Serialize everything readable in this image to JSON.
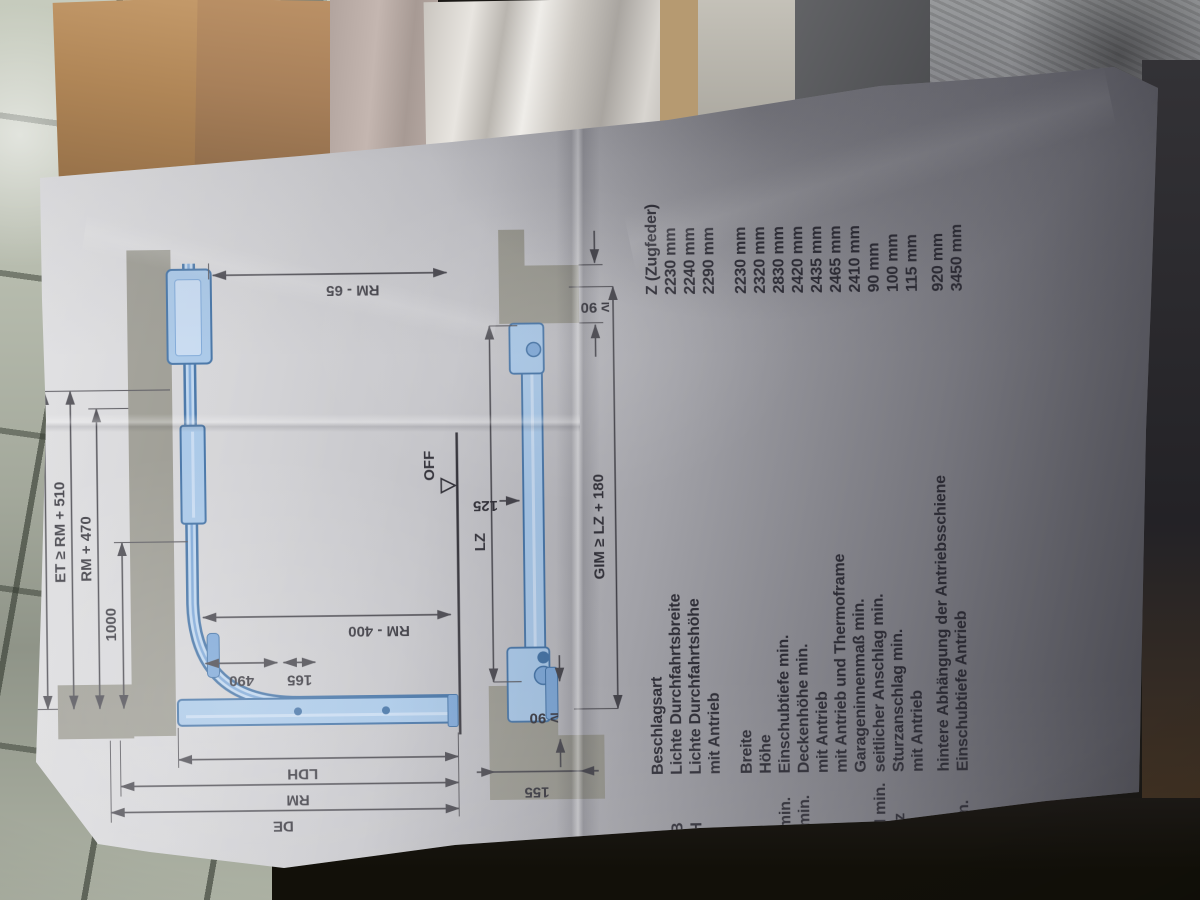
{
  "photo": {
    "description": "Crumpled garage-door fitting instruction sheet photographed on a tiled floor, rotated 90 degrees",
    "colors": {
      "diagram_blue_fill": "#a6c6e7",
      "diagram_blue_stroke": "#3f6fa3",
      "masonry_gray": "#99988f",
      "print_ink": "#32313a",
      "paper_light": "#e0e0e2",
      "paper_shadow": "#717078"
    },
    "table": {
      "rows": [
        {
          "abbr": "",
          "label": "Beschlagsart",
          "value": "Z (Zugfeder)"
        },
        {
          "abbr": "LDB",
          "label": "Lichte Durchfahrtsbreite",
          "value": "2230 mm"
        },
        {
          "abbr": "LDH",
          "label": "Lichte Durchfahrtshöhe",
          "value": "2240 mm"
        },
        {
          "abbr": "",
          "label": "mit Antrieb",
          "value": "2290 mm"
        },
        {
          "abbr": "LZ",
          "label": "Breite",
          "value": "2230 mm"
        },
        {
          "abbr": "RM",
          "label": "Höhe",
          "value": "2320 mm"
        },
        {
          "abbr": "ET min.",
          "label": "Einschubtiefe min.",
          "value": "2830 mm"
        },
        {
          "abbr": "DE min.",
          "label": "Deckenhöhe min.",
          "value": "2420 mm"
        },
        {
          "abbr": "",
          "label": "mit Antrieb",
          "value": "2435 mm"
        },
        {
          "abbr": "",
          "label": "mit Antrieb und Thermoframe",
          "value": "2465 mm"
        },
        {
          "abbr": "GIM",
          "label": "Garageninnenmaß min.",
          "value": "2410 mm"
        },
        {
          "abbr": "SAN min.",
          "label": "seitlicher Anschlag min.",
          "value": "90 mm"
        },
        {
          "abbr": "Sturz",
          "label": "Sturzanschlag min.",
          "value": "100 mm"
        },
        {
          "abbr": "",
          "label": "mit Antrieb",
          "value": "115 mm"
        },
        {
          "abbr": "V1",
          "label": "hintere Abhängung der Antriebsschiene",
          "value": "920 mm"
        },
        {
          "abbr": "W min.",
          "label": "Einschubtiefe Antrieb",
          "value": "3450 mm"
        }
      ]
    },
    "side_view": {
      "v1": "V1",
      "et": "ET ≥ RM + 510",
      "rm470": "RM + 470",
      "d1000": "1000",
      "rm65": "RM - 65",
      "rm400": "RM - 400",
      "d490": "490",
      "d165": "165",
      "ldh": "LDH",
      "rm": "RM",
      "de": "DE",
      "off": "OFF"
    },
    "plan_view": {
      "lz": "LZ",
      "d125": "125",
      "gim": "GIM ≥ LZ + 180",
      "ge90_left": "≥ 90",
      "ge90_right": "≥ 90",
      "d155": "155"
    }
  }
}
